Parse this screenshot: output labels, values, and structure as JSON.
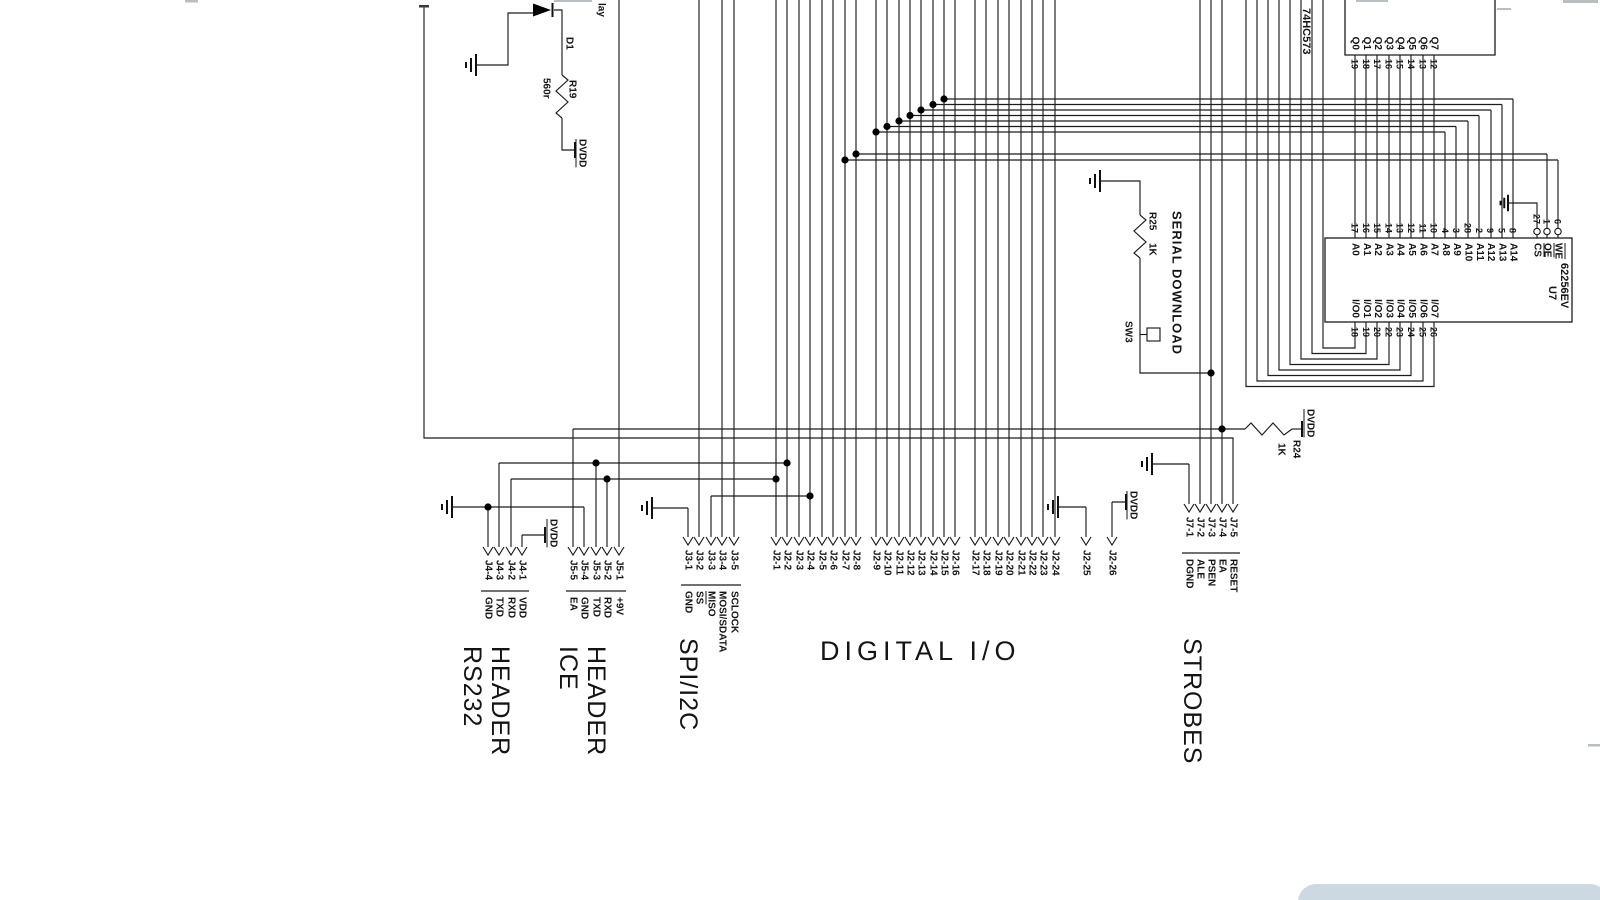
{
  "sections": {
    "rs232": {
      "line1": "RS232",
      "line2": "HEADER"
    },
    "ice": {
      "line1": "ICE",
      "line2": "HEADER"
    },
    "spi": {
      "title": "SPI/I2C"
    },
    "digital_io": {
      "title": "DIGITAL I/O"
    },
    "strobes": {
      "title": "STROBES"
    },
    "serial_download": {
      "title": "SERIAL DOWNLOAD"
    }
  },
  "power": {
    "dvdd": "DVDD"
  },
  "partial_label": {
    "text": "lay"
  },
  "components": {
    "d1": {
      "ref": "D1"
    },
    "r19": {
      "ref": "R19",
      "value": "560r"
    },
    "r24": {
      "ref": "R24",
      "value": "1K"
    },
    "r25": {
      "ref": "R25",
      "value": "1K"
    },
    "sw3": {
      "ref": "SW3"
    },
    "latch": {
      "part": "74HC573",
      "pins": [
        {
          "name": "Q0",
          "num": "19"
        },
        {
          "name": "Q1",
          "num": "18"
        },
        {
          "name": "Q2",
          "num": "17"
        },
        {
          "name": "Q3",
          "num": "16"
        },
        {
          "name": "Q4",
          "num": "15"
        },
        {
          "name": "Q5",
          "num": "14"
        },
        {
          "name": "Q6",
          "num": "13"
        },
        {
          "name": "Q7",
          "num": "12"
        }
      ]
    },
    "u7": {
      "ref": "U7",
      "part": "62256EV",
      "addr_pins": [
        {
          "name": "A0",
          "num": "17"
        },
        {
          "name": "A1",
          "num": "16"
        },
        {
          "name": "A2",
          "num": "15"
        },
        {
          "name": "A3",
          "num": "14"
        },
        {
          "name": "A4",
          "num": "13"
        },
        {
          "name": "A5",
          "num": "12"
        },
        {
          "name": "A6",
          "num": "11"
        },
        {
          "name": "A7",
          "num": "10"
        },
        {
          "name": "A8",
          "num": "4"
        },
        {
          "name": "A9",
          "num": "3"
        },
        {
          "name": "A10",
          "num": "28"
        },
        {
          "name": "A11",
          "num": "2"
        },
        {
          "name": "A12",
          "num": "9"
        },
        {
          "name": "A13",
          "num": "5"
        },
        {
          "name": "A14",
          "num": "8"
        }
      ],
      "ctrl_pins": [
        {
          "name": "CS",
          "num": "27",
          "overline": true
        },
        {
          "name": "OE",
          "num": "1",
          "overline": true
        },
        {
          "name": "WE",
          "num": "6",
          "overline": true
        }
      ],
      "io_pins": [
        {
          "name": "I/O0",
          "num": "18"
        },
        {
          "name": "I/O1",
          "num": "19"
        },
        {
          "name": "I/O2",
          "num": "20"
        },
        {
          "name": "I/O3",
          "num": "22"
        },
        {
          "name": "I/O4",
          "num": "23"
        },
        {
          "name": "I/O5",
          "num": "24"
        },
        {
          "name": "I/O6",
          "num": "25"
        },
        {
          "name": "I/O7",
          "num": "26"
        }
      ]
    }
  },
  "connectors": {
    "j4": {
      "pins": [
        {
          "pin": "J4-4",
          "signal": "GND"
        },
        {
          "pin": "J4-3",
          "signal": "TXD"
        },
        {
          "pin": "J4-2",
          "signal": "RXD"
        },
        {
          "pin": "J4-1",
          "signal": "VDD"
        }
      ]
    },
    "j5": {
      "pins": [
        {
          "pin": "J5-5",
          "signal": "EA"
        },
        {
          "pin": "J5-4",
          "signal": "GND"
        },
        {
          "pin": "J5-3",
          "signal": "TXD"
        },
        {
          "pin": "J5-2",
          "signal": "RXD"
        },
        {
          "pin": "J5-1",
          "signal": "+9V"
        }
      ]
    },
    "j3": {
      "pins": [
        {
          "pin": "J3-1",
          "signal": "GND"
        },
        {
          "pin": "J3-2",
          "signal": "SS",
          "overline": true
        },
        {
          "pin": "J3-3",
          "signal": "MISO"
        },
        {
          "pin": "J3-4",
          "signal": "MOSI/SDATA"
        },
        {
          "pin": "J3-5",
          "signal": "SCLOCK"
        }
      ]
    },
    "j2": {
      "pins": [
        {
          "pin": "J2-1"
        },
        {
          "pin": "J2-2"
        },
        {
          "pin": "J2-3"
        },
        {
          "pin": "J2-4"
        },
        {
          "pin": "J2-5"
        },
        {
          "pin": "J2-6"
        },
        {
          "pin": "J2-7"
        },
        {
          "pin": "J2-8"
        },
        {
          "pin": "J2-9"
        },
        {
          "pin": "J2-10"
        },
        {
          "pin": "J2-11"
        },
        {
          "pin": "J2-12"
        },
        {
          "pin": "J2-13"
        },
        {
          "pin": "J2-14"
        },
        {
          "pin": "J2-15"
        },
        {
          "pin": "J2-16"
        },
        {
          "pin": "J2-17"
        },
        {
          "pin": "J2-18"
        },
        {
          "pin": "J2-19"
        },
        {
          "pin": "J2-20"
        },
        {
          "pin": "J2-21"
        },
        {
          "pin": "J2-22"
        },
        {
          "pin": "J2-23"
        },
        {
          "pin": "J2-24"
        },
        {
          "pin": "J2-25"
        },
        {
          "pin": "J2-26"
        }
      ]
    },
    "j7": {
      "pins": [
        {
          "pin": "J7-1",
          "signal": "DGND"
        },
        {
          "pin": "J7-2",
          "signal": "ALE"
        },
        {
          "pin": "J7-3",
          "signal": "PSEN"
        },
        {
          "pin": "J7-4",
          "signal": "EA"
        },
        {
          "pin": "J7-5",
          "signal": "RESET"
        }
      ]
    }
  }
}
